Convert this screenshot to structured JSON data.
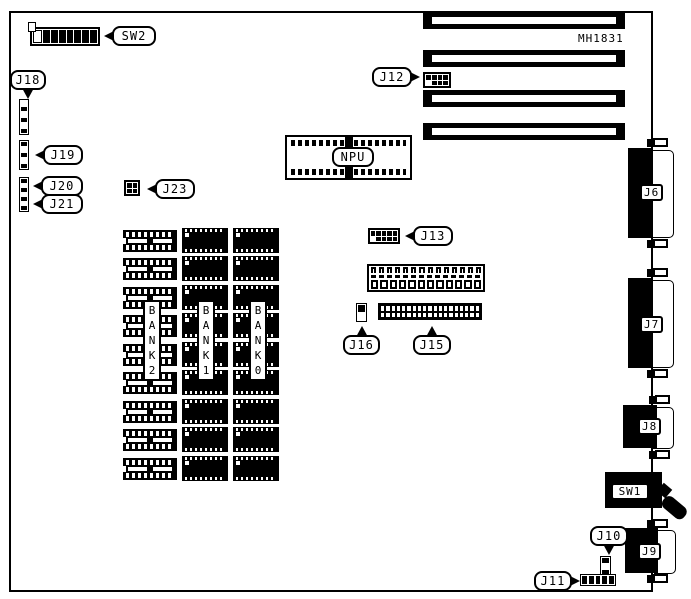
{
  "board": {
    "part_number": "MH1831",
    "background": "#ffffff",
    "ink": "#000000",
    "type": "motherboard-jumper-diagram"
  },
  "labels": {
    "sw2": "SW2",
    "j12": "J12",
    "j18": "J18",
    "j19": "J19",
    "j20": "J20",
    "j21": "J21",
    "j23": "J23",
    "npu": "NPU",
    "j13": "J13",
    "j15": "J15",
    "j16": "J16",
    "j6": "J6",
    "j7": "J7",
    "j8": "J8",
    "j9": "J9",
    "j10": "J10",
    "j11": "J11",
    "sw1": "SW1",
    "bank0": "B\nA\nN\nK\n0",
    "bank1": "B\nA\nN\nK\n1",
    "bank2": "B\nA\nN\nK\n2"
  },
  "dip_switch_sw2": {
    "positions": 8
  },
  "expansion_slots": {
    "count": 4
  },
  "memory": {
    "banks": [
      {
        "name": "BANK2",
        "devices": 9,
        "style": "socket"
      },
      {
        "name": "BANK1",
        "devices": 9,
        "style": "chip"
      },
      {
        "name": "BANK0",
        "devices": 9,
        "style": "chip"
      }
    ]
  },
  "connectors": {
    "j12": {
      "rows": 2,
      "cols": 4
    },
    "j13": {
      "rows": 2,
      "cols": 5
    },
    "j23": {
      "rows": 2,
      "cols": 2
    },
    "j15": {
      "rows": 2,
      "cols": 19
    },
    "edge_connector": {
      "hooks": 14,
      "squares": 12
    },
    "j18": {
      "pins": 6
    },
    "j19": {
      "pins": 5
    },
    "j20_j21": {
      "pins": 7
    },
    "j16": {
      "pins": 2
    },
    "j10": {
      "pins": 3
    },
    "j11": {
      "pins": 5
    }
  }
}
